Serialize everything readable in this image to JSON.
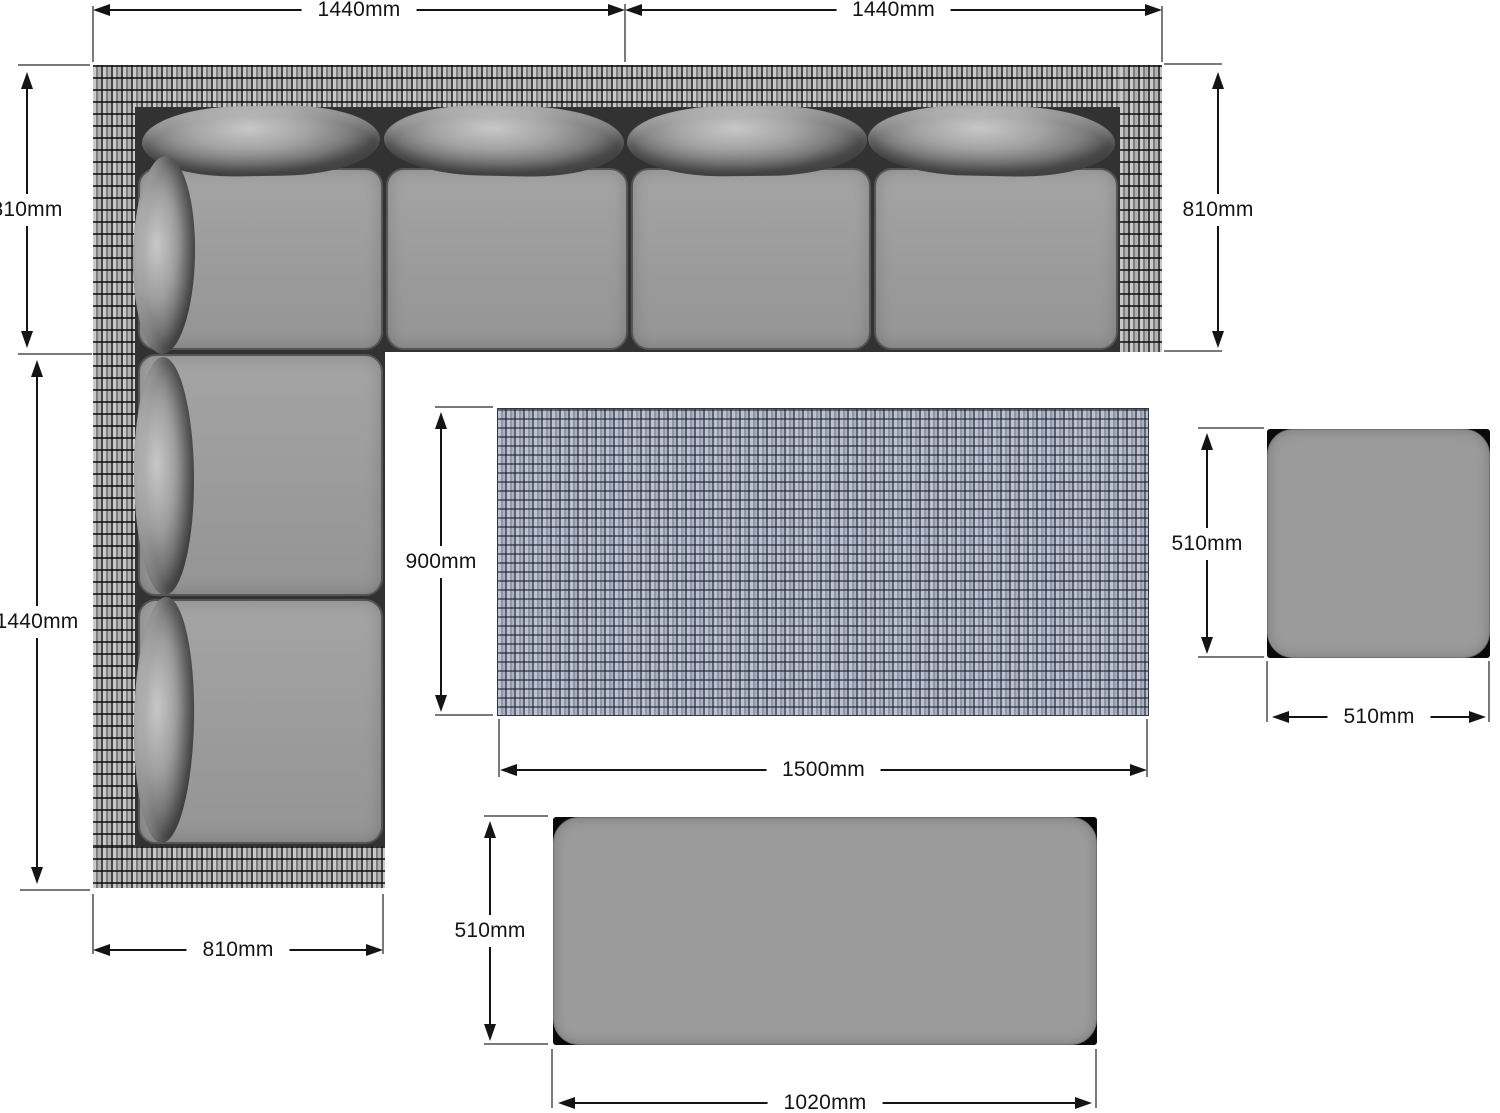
{
  "dims": {
    "sofa_top_left": "1440mm",
    "sofa_top_right": "1440mm",
    "sofa_left_top": "810mm",
    "sofa_right": "810mm",
    "sofa_left_bottom": "1440mm",
    "sofa_bottom": "810mm",
    "table_depth": "900mm",
    "table_width": "1500mm",
    "stool_depth": "510mm",
    "stool_width": "510mm",
    "bench_depth": "510mm",
    "bench_width": "1020mm"
  },
  "colors": {
    "background": "#ffffff",
    "dimension_line": "#141414",
    "tick_line": "#7a7a7a",
    "cushion_gray": "#9b9b9b",
    "sofa_frame_dark": "#323232",
    "rattan_light": "#c9c9c9",
    "rattan_dark": "#454545",
    "table_weave_base": "#7f8798",
    "table_weave_light": "#bcc2cf",
    "table_weave_dark": "#5d6472"
  }
}
